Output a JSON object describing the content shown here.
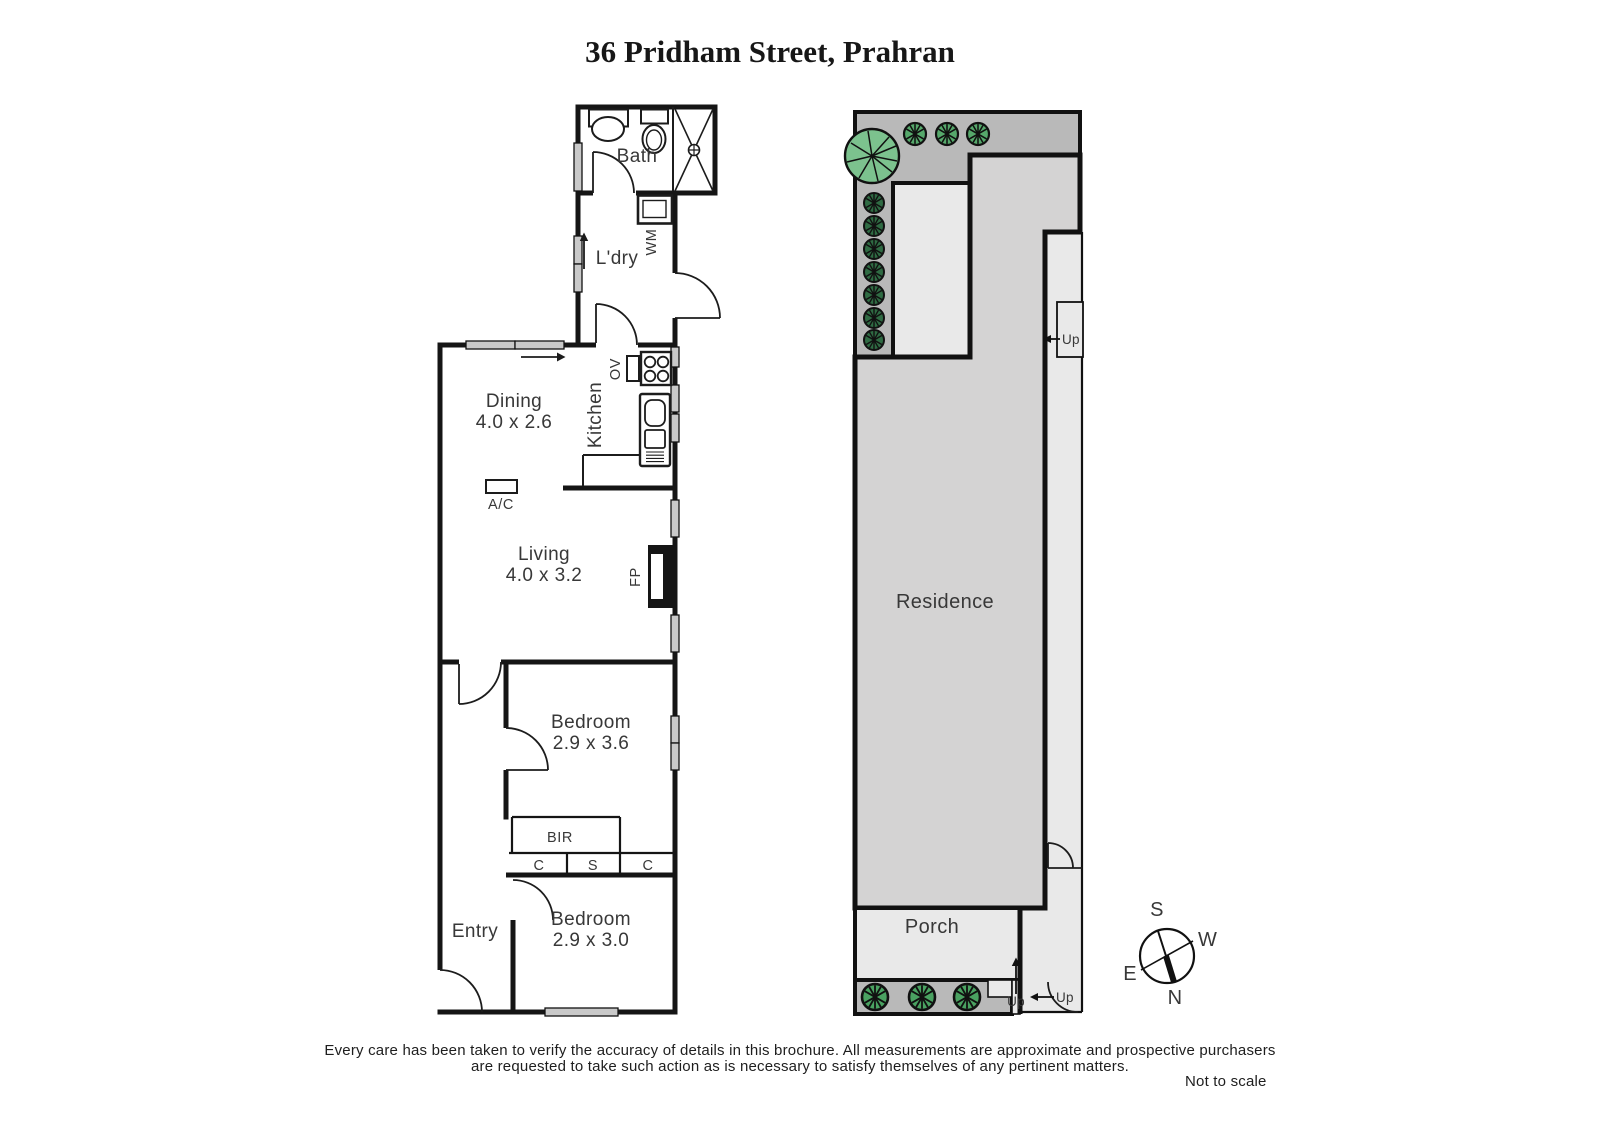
{
  "title": "36 Pridham Street, Prahran",
  "floor_plan": {
    "bath": "Bath",
    "laundry": "L'dry",
    "wm": "WM",
    "kitchen": "Kitchen",
    "ov": "OV",
    "dining": "Dining",
    "dining_dims": "4.0 x 2.6",
    "ac": "A/C",
    "living": "Living",
    "living_dims": "4.0 x 3.2",
    "fp": "FP",
    "bedroom1": "Bedroom",
    "bedroom1_dims": "2.9 x 3.6",
    "bir": "BIR",
    "closet_left": "C",
    "closet_shelf": "S",
    "closet_right": "C",
    "entry": "Entry",
    "bedroom2": "Bedroom",
    "bedroom2_dims": "2.9 x 3.0"
  },
  "site_plan": {
    "residence": "Residence",
    "porch": "Porch",
    "up_side_step": "Up",
    "up_porch_step": "Up",
    "up_gate_step": "Up"
  },
  "compass": {
    "north": "N",
    "south": "S",
    "east": "E",
    "west": "W"
  },
  "footer": {
    "disclaimer_line1": "Every care has been taken to verify the accuracy of details in this brochure.  All measurements are approximate and prospective purchasers",
    "disclaimer_line2": "are requested to take such action as is necessary to satisfy themselves of any pertinent matters.",
    "scale_note": "Not to scale"
  },
  "colors": {
    "wall": "#151515",
    "window_fill": "#c9c9c9",
    "garden_bed": "#b9b9b9",
    "walkway": "#e9e9e9",
    "residence_fill": "#d4d3d3",
    "tree_green": "#7cc28e",
    "bush_dark_green": "#2f6b43",
    "bush_mid_green": "#56a86b",
    "bush_bottom_green": "#4aa261"
  }
}
